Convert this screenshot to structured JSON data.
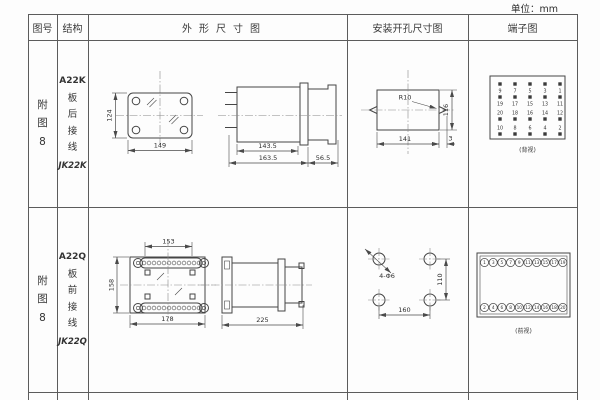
{
  "unit_label": "单位：mm",
  "table": {
    "headers": {
      "fig_no": "图号",
      "structure": "结构",
      "outline": "外形尺寸图",
      "mounting": "安装开孔尺寸图",
      "terminal": "端子图"
    },
    "rows": [
      {
        "fig_no": "附图8",
        "structure": {
          "model": "A22K",
          "wiring": "板后接线",
          "relay_type": "JK22K"
        },
        "outline": {
          "front_height": "124",
          "front_width": "149",
          "body_length": "143.5",
          "total_length": "163.5",
          "flange_depth": "56.5"
        },
        "mounting": {
          "corner_radius": "R10",
          "cutout_width": "141",
          "cutout_height": "116",
          "notch_depth": "3"
        },
        "terminal": {
          "view_label": "(背视)",
          "rows": [
            {
              "dot_position": "above",
              "labels": [
                "9",
                "7",
                "5",
                "3",
                "1"
              ]
            },
            {
              "dot_position": "above",
              "labels": [
                "19",
                "17",
                "15",
                "13",
                "11"
              ]
            },
            {
              "dot_position": "below",
              "labels": [
                "20",
                "18",
                "16",
                "14",
                "12"
              ]
            },
            {
              "dot_position": "below",
              "labels": [
                "10",
                "8",
                "6",
                "4",
                "2"
              ]
            }
          ]
        }
      },
      {
        "fig_no": "附图8",
        "structure": {
          "model": "A22Q",
          "wiring": "板前接线",
          "relay_type": "JK22Q"
        },
        "outline": {
          "front_top_width": "153",
          "front_height": "158",
          "front_bottom_width": "178",
          "total_depth": "225"
        },
        "mounting": {
          "holes_label": "4-Φ6",
          "hole_spacing_v": "110",
          "hole_spacing_h": "160"
        },
        "terminal": {
          "view_label": "(前视)",
          "rows": [
            {
              "labels": [
                "1",
                "3",
                "5",
                "7",
                "9",
                "11",
                "13",
                "15",
                "17",
                "19"
              ]
            },
            {
              "labels": [
                "2",
                "4",
                "6",
                "8",
                "10",
                "12",
                "14",
                "16",
                "18",
                "20"
              ]
            }
          ]
        }
      }
    ]
  }
}
